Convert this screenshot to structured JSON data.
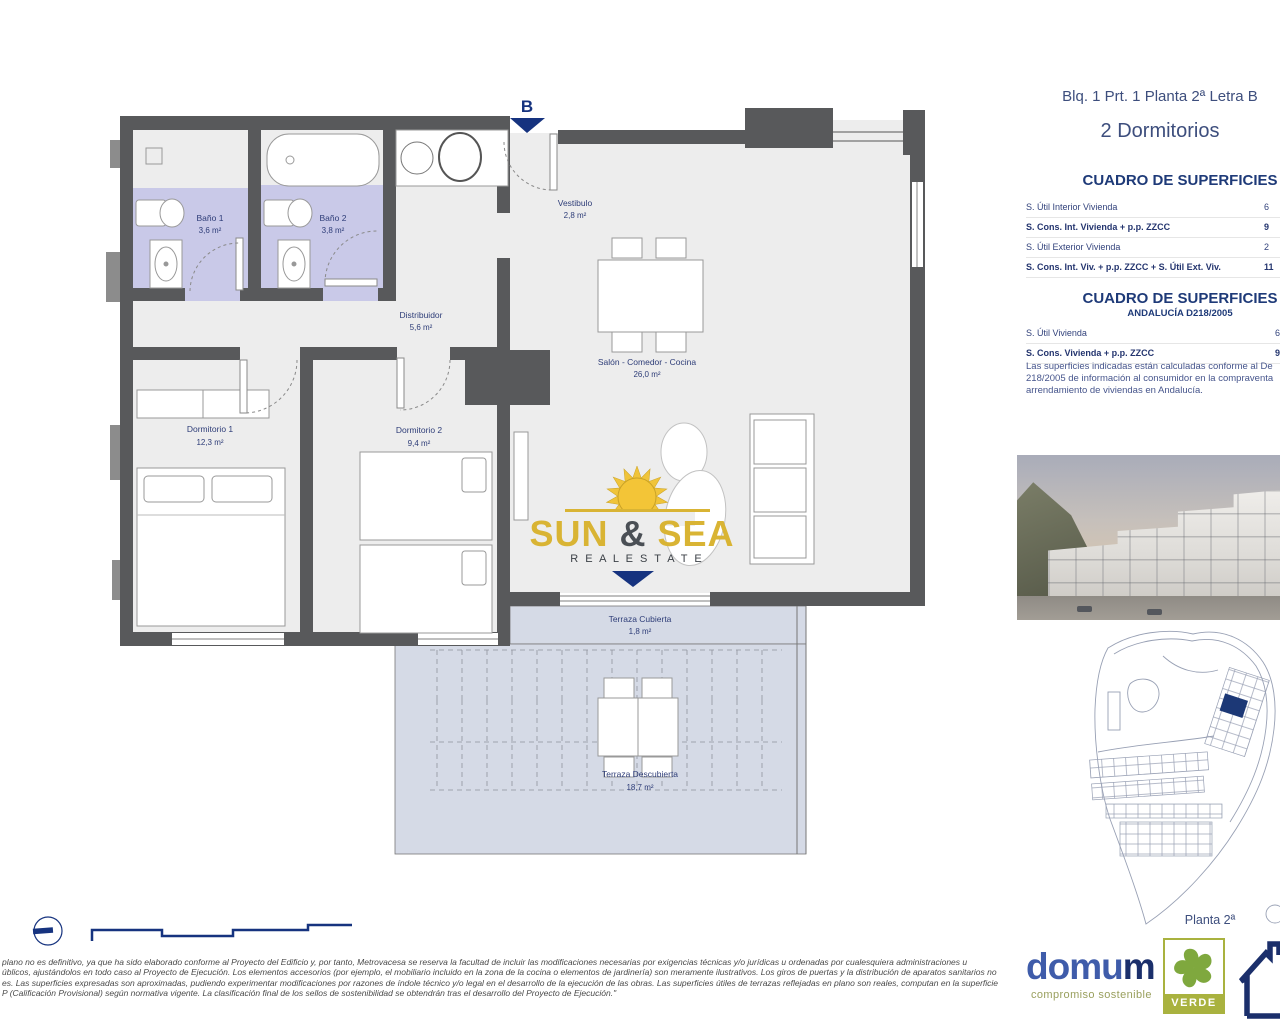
{
  "plan": {
    "entrance_marker": "B",
    "rooms": {
      "bano1": {
        "name": "Baño 1",
        "area": "3,6 m²"
      },
      "bano2": {
        "name": "Baño 2",
        "area": "3,8 m²"
      },
      "vestibulo": {
        "name": "Vestibulo",
        "area": "2,8 m²"
      },
      "distribuidor": {
        "name": "Distribuidor",
        "area": "5,6 m²"
      },
      "salon": {
        "name": "Salón - Comedor - Cocina",
        "area": "26,0 m²"
      },
      "dormitorio1": {
        "name": "Dormitorio 1",
        "area": "12,3 m²"
      },
      "dormitorio2": {
        "name": "Dormitorio 2",
        "area": "9,4 m²"
      },
      "terraza_cubierta": {
        "name": "Terraza Cubierta",
        "area": "1,8 m²"
      },
      "terraza_descubierta": {
        "name": "Terraza Descubierta",
        "area": "18,7 m²"
      }
    },
    "logo": {
      "word1": "SUN",
      "amp": "&",
      "word2": "SEA",
      "tagline": "R E A L   E S T A T E"
    }
  },
  "info": {
    "title": "Blq. 1 Prt. 1 Planta 2ª Letra B",
    "subtitle": "2 Dormitorios",
    "table1": {
      "heading": "CUADRO DE SUPERFICIES",
      "rows": [
        {
          "label": "S. Útil Interior Vivienda",
          "value": "6"
        },
        {
          "label": "S. Cons. Int. Vivienda + p.p. ZZCC",
          "value": "9"
        },
        {
          "label": "S. Útil Exterior Vivienda",
          "value": "2"
        },
        {
          "label": "S. Cons. Int. Viv. + p.p. ZZCC + S. Útil Ext. Viv.",
          "value": "11"
        }
      ]
    },
    "table2": {
      "heading": "CUADRO DE SUPERFICIES",
      "subheading": "ANDALUCÍA D218/2005",
      "rows": [
        {
          "label": "S. Útil Vivienda",
          "value": "6"
        },
        {
          "label": "S. Cons. Vivienda + p.p. ZZCC",
          "value": "9"
        }
      ],
      "note_lines": [
        "Las superficies indicadas están calculadas conforme al De",
        "218/2005 de información al consumidor en la compraventa",
        "arrendamiento de viviendas en Andalucía."
      ]
    },
    "siteplan_label": "Planta 2ª"
  },
  "footer": {
    "disclaimer_lines": [
      "plano no es definitivo, ya que ha sido elaborado conforme al Proyecto del Edificio y, por tanto, Metrovacesa se reserva la facultad de incluir las modificaciones necesarias por exigencias técnicas y/o jurídicas u ordenadas por cualesquiera administraciones u",
      "úblicos, ajustándolos en todo caso al Proyecto de Ejecución. Los elementos accesorios (por ejemplo, el mobiliario incluido en la zona de la cocina o elementos de jardinería) son meramente ilustrativos. Los giros de puertas y la distribución de aparatos sanitarios no",
      "es. Las superficies expresadas son aproximadas, pudiendo experimentar modificaciones por razones de índole técnico y/o legal en el desarrollo de la ejecución de las obras. Las superficies útiles de terrazas reflejadas en plano son reales, computan en la superficie",
      "P (Calificación Provisional) según normativa vigente. La clasificación final de los sellos de sostenibilidad se obtendrán tras el desarrollo del Proyecto de Ejecución.\""
    ],
    "domum_name_a": "domu",
    "domum_name_b": "m",
    "domum_tagline": "compromiso sostenible",
    "verde_label": "VERDE"
  },
  "colors": {
    "accent_navy": "#16337f",
    "heading_blue": "#1e3a78",
    "title_slate": "#3d4e7d",
    "bath_lavender": "#c9c9e8",
    "terrace_blue": "#d5dae6",
    "wall_gray": "#58595b",
    "floor_gray": "#ededed",
    "logo_gold": "#d9b434",
    "olive_green": "#a9b23f",
    "domum_blue": "#3f5caa",
    "domum_navy": "#1b2f6b"
  }
}
